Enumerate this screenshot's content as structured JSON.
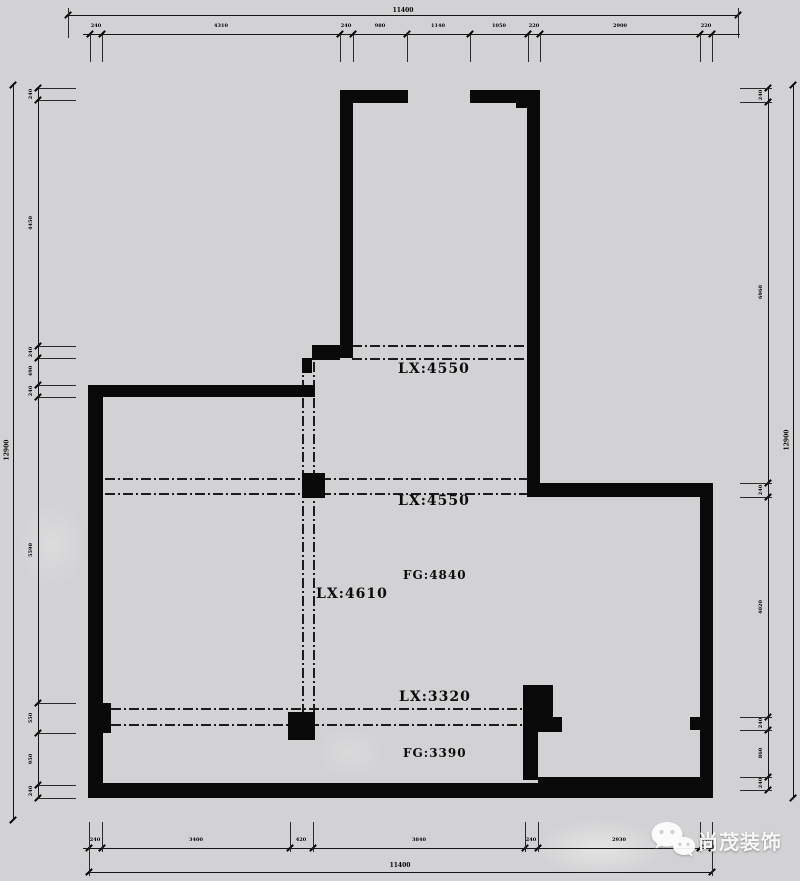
{
  "annotations": {
    "beam_upper": "LX:4550",
    "beam_middle": "LX:4550",
    "beam_vertical": "LX:4610",
    "beam_lower": "LX:3320",
    "height_upper": "FG:4840",
    "height_lower": "FG:3390"
  },
  "dimensions": {
    "top": {
      "overall": "11400",
      "segments": [
        "240",
        "4310",
        "240",
        "980",
        "1140",
        "1050",
        "220",
        "2900",
        "220"
      ]
    },
    "bottom": {
      "overall": "11400",
      "segments": [
        "240",
        "3400",
        "420",
        "3840",
        "240",
        "2930",
        "240"
      ]
    },
    "left": {
      "overall": "12900",
      "segments": [
        "240",
        "4450",
        "240",
        "490",
        "240",
        "5590",
        "550",
        "950",
        "240"
      ]
    },
    "right": {
      "overall": "12900",
      "segments": [
        "240",
        "6960",
        "240",
        "4020",
        "240",
        "860",
        "240"
      ]
    }
  },
  "watermark": {
    "brand": "尚茂装饰",
    "icon": "wechat-icon"
  },
  "colors": {
    "background": "#d2d2d4",
    "wall": "#090909",
    "line": "#161616",
    "watermark_text": "#ffffff"
  }
}
